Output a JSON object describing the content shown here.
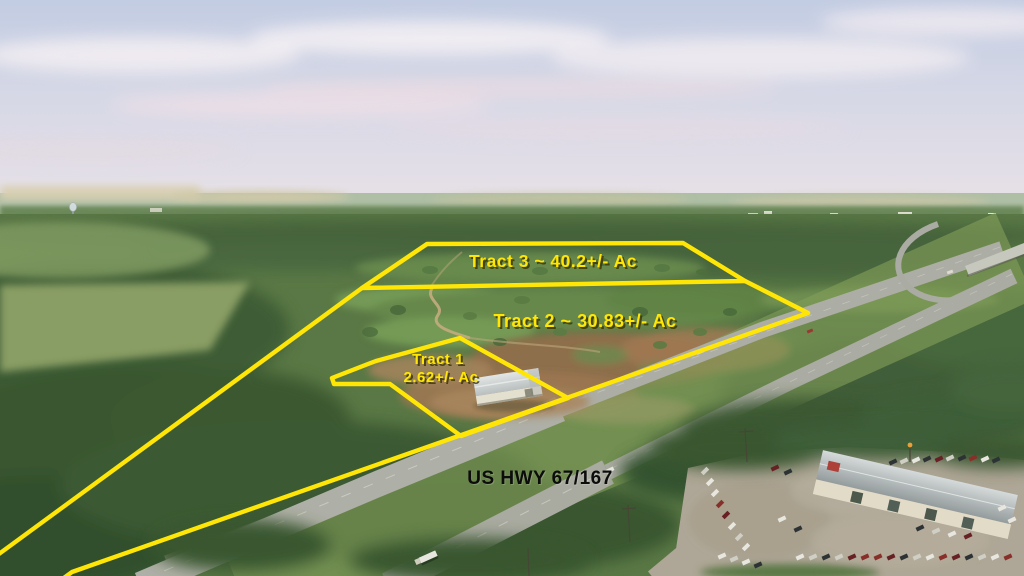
{
  "labels": {
    "tract3": "Tract 3 ~ 40.2+/- Ac",
    "tract2": "Tract 2 ~ 30.83+/- Ac",
    "tract1_name": "Tract 1",
    "tract1_acres": "2.62+/- Ac",
    "highway": "US HWY 67/167"
  },
  "tracts": [
    {
      "name": "Tract 1",
      "acres": "2.62+/- Ac"
    },
    {
      "name": "Tract 2",
      "acres": "30.83+/- Ac"
    },
    {
      "name": "Tract 3",
      "acres": "40.2+/- Ac"
    }
  ],
  "colors": {
    "boundary": "#ffe606",
    "label_text": "#ffe606",
    "label_shadow": "#3e3804",
    "highway_label": "#0c0c0c"
  }
}
